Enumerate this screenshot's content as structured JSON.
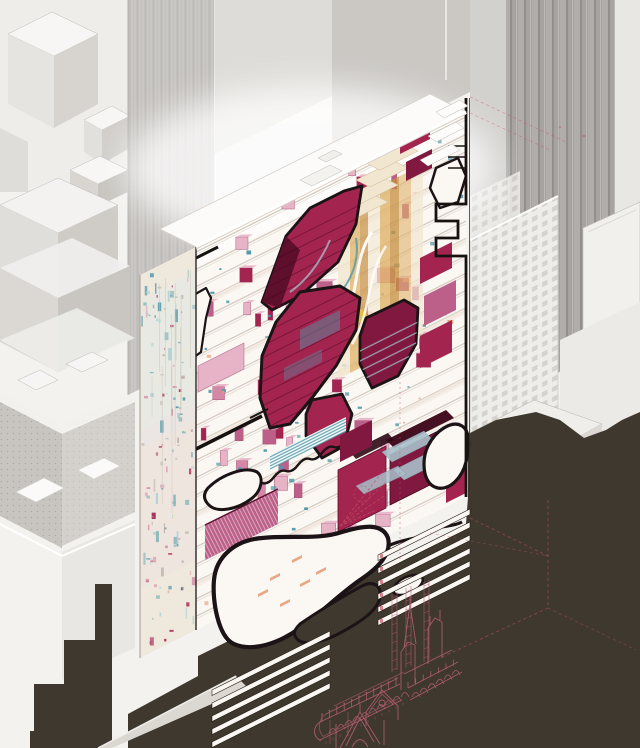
{
  "canvas": {
    "width": 640,
    "height": 748
  },
  "scene": {
    "title": "Axonometric architectural cutaway drawing: slab tower with crimson program volumes and white voids among gray city blocks, above a wireframe cathedral",
    "type": "architectural-axonometric-cutaway",
    "elements": [
      "context-buildings-left",
      "context-buildings-right",
      "shadow-silhouette",
      "tower-cut-face",
      "tower-collage-facade",
      "tower-roof",
      "crimson-program-volumes",
      "white-void-blobs",
      "amber-atrium",
      "louver-slats",
      "section-cut-line",
      "cathedral-wireframe",
      "red-dashed-construction-lines"
    ]
  },
  "palette": {
    "paper": "#f3f2ef",
    "ctx_face": "#e4e2de",
    "ctx_face_light": "#eeedea",
    "ctx_face_dark": "#d2d0cc",
    "ctx_top": "#f7f6f4",
    "ctx_edge": "#bdbab6",
    "stripe_gray": "#c9c6c3",
    "stripe_dark": "#aeaba7",
    "fluted": "#a7a4a1",
    "window_face": "#efedea",
    "window_cell": "#d6d3cf",
    "shadow": "#3e382f",
    "shadow_light": "#4b443a",
    "tower_white": "#fbf8f4",
    "floor_line": "#d6cbc2",
    "floor_warm": "#f0e6da",
    "pink": "#d488a7",
    "pink_light": "#e7b3c6",
    "pink_dark": "#bc6089",
    "crimson": "#a42450",
    "crimson_dark": "#811840",
    "crimson_deep": "#5e0f2b",
    "blob_stroke": "#1b1315",
    "teal": "#4f98a8",
    "teal_light": "#a8cdd2",
    "amber": "#e0b36a",
    "amber_deep": "#c68f3e",
    "gold": "#e6c23f",
    "cream": "#f1e6cf",
    "salmon": "#e89a74",
    "cathedral": "#b25c70",
    "dash_red": "#c25563",
    "street": "#dbd8d2",
    "black_accent": "#17120f"
  }
}
